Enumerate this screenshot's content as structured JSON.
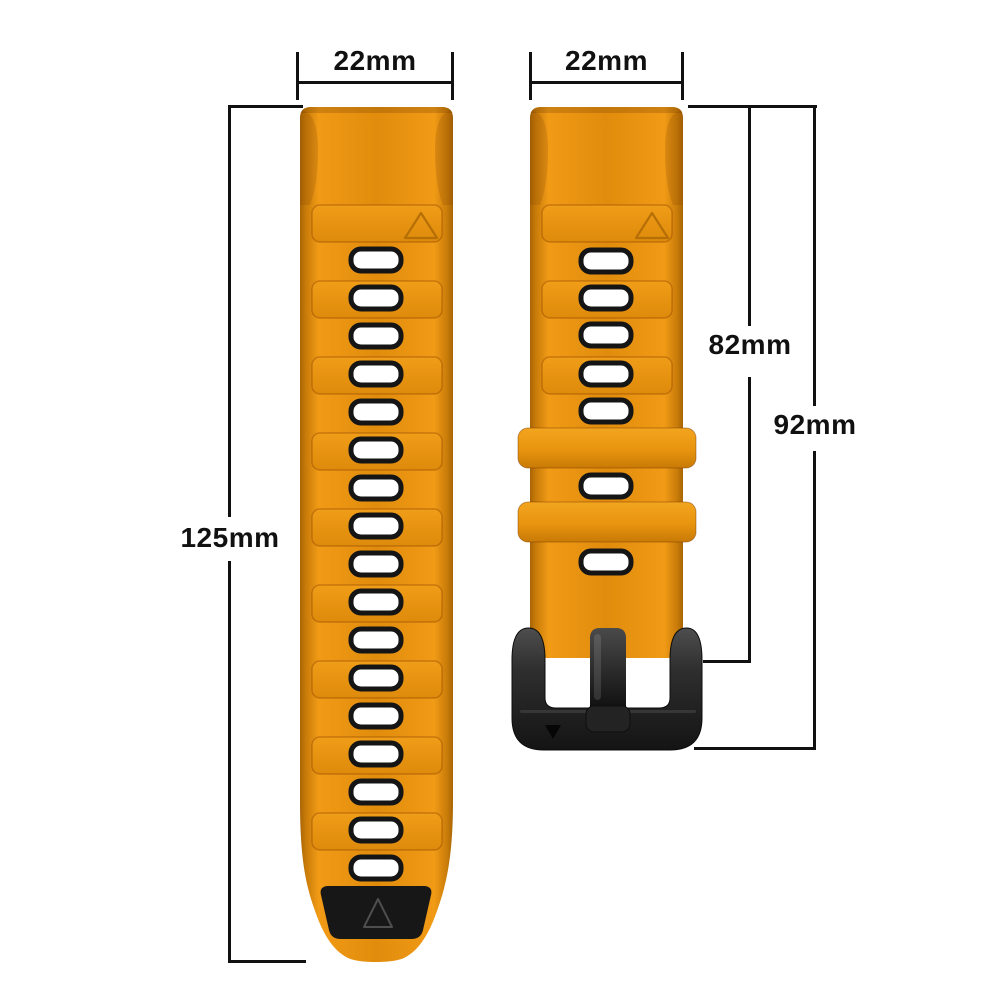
{
  "diagram": {
    "background_color": "#FFFFFF",
    "labels": {
      "left_strap_width": "22mm",
      "right_strap_width": "22mm",
      "left_strap_length": "125mm",
      "right_strap_length_to_buckle": "82mm",
      "right_strap_length_total": "92mm"
    }
  },
  "straps": {
    "left": {
      "feature": "long-half-with-triangle-tip",
      "hole_center_x": 376,
      "hole_centers_y": [
        260,
        298,
        336,
        374,
        412,
        450,
        488,
        526,
        564,
        602,
        640,
        678,
        716,
        754,
        792,
        830,
        868
      ],
      "band_x": 312,
      "band_width": 130,
      "band_tops_y": [
        205,
        281,
        357,
        433,
        509,
        585,
        661,
        737,
        813
      ]
    },
    "right": {
      "feature": "buckle-half-with-two-keepers",
      "hole_center_x": 606,
      "hole_centers_y": [
        261,
        298,
        335,
        374,
        411,
        486,
        562
      ],
      "band_x": 542,
      "band_width": 130,
      "band_tops_y": [
        205,
        281,
        357
      ],
      "keeper_x": 518,
      "keeper_width": 178,
      "keeper_tops_y": [
        428,
        502
      ]
    }
  },
  "colors": {
    "strap_orange": "#E28C0D",
    "strap_orange_light": "#F09A16",
    "strap_orange_dark": "#B06A05",
    "hole_fill": "#FFFFFF",
    "hole_border": "#151515",
    "band_outline": "rgba(140,65,0,0.40)",
    "buckle_dark": "#1E1E1E",
    "tip_black": "#171717",
    "dimension_line": "#111111",
    "label_text": "#111111"
  }
}
